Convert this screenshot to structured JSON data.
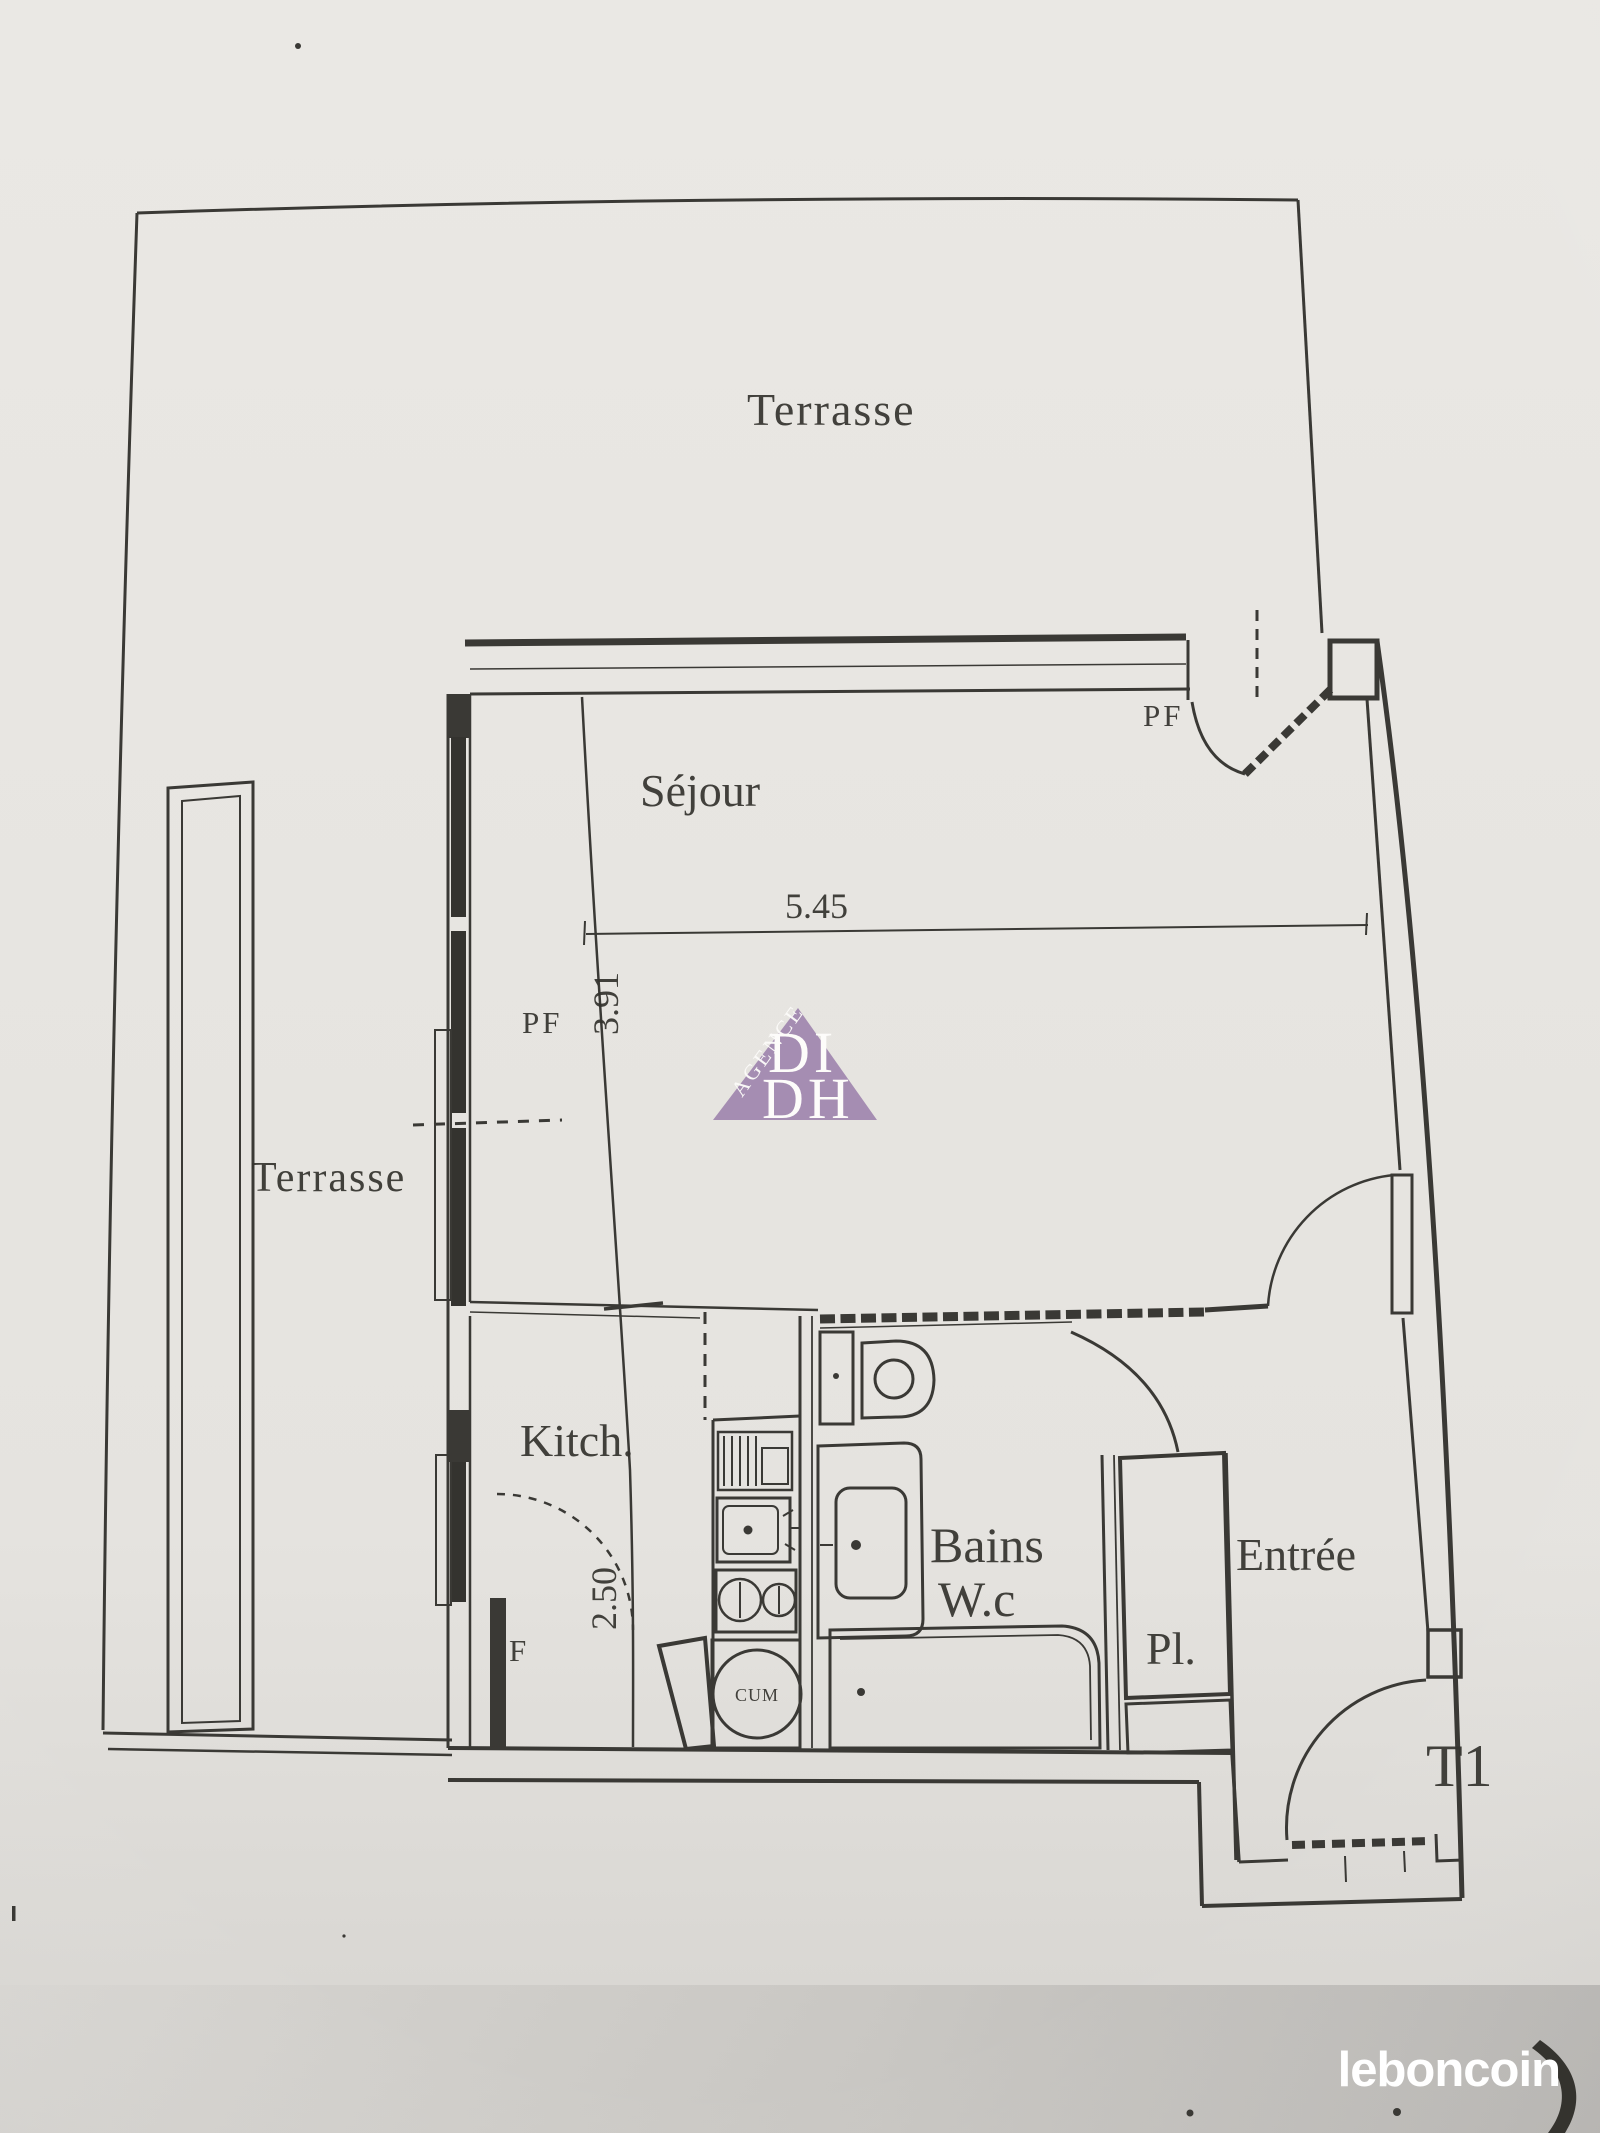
{
  "photo": {
    "paper_color": "#e9e7e3",
    "ink_color": "#3a3935",
    "shadow_color": "#b7b5b2"
  },
  "plan": {
    "rooms": {
      "terrasse_top": "Terrasse",
      "terrasse_left": "Terrasse",
      "sejour": "Séjour",
      "kitchen": "Kitch.",
      "bains": "Bains",
      "wc": "W.c",
      "entree": "Entrée",
      "placard": "Pl.",
      "type": "T1"
    },
    "dimensions": {
      "sejour_width": "5.45",
      "sejour_depth": "3.91",
      "kitchen_depth": "2.50"
    },
    "openings": {
      "pf_top": "PF",
      "pf_left": "PF",
      "window_f": "F"
    },
    "equipment": {
      "water_heater": "CUM"
    }
  },
  "watermark": {
    "agency": "AGENCE",
    "line1": "DI",
    "line2": "DH",
    "triangle_color": "#9c81ab"
  },
  "brand": {
    "logo_text": "leboncoin"
  }
}
